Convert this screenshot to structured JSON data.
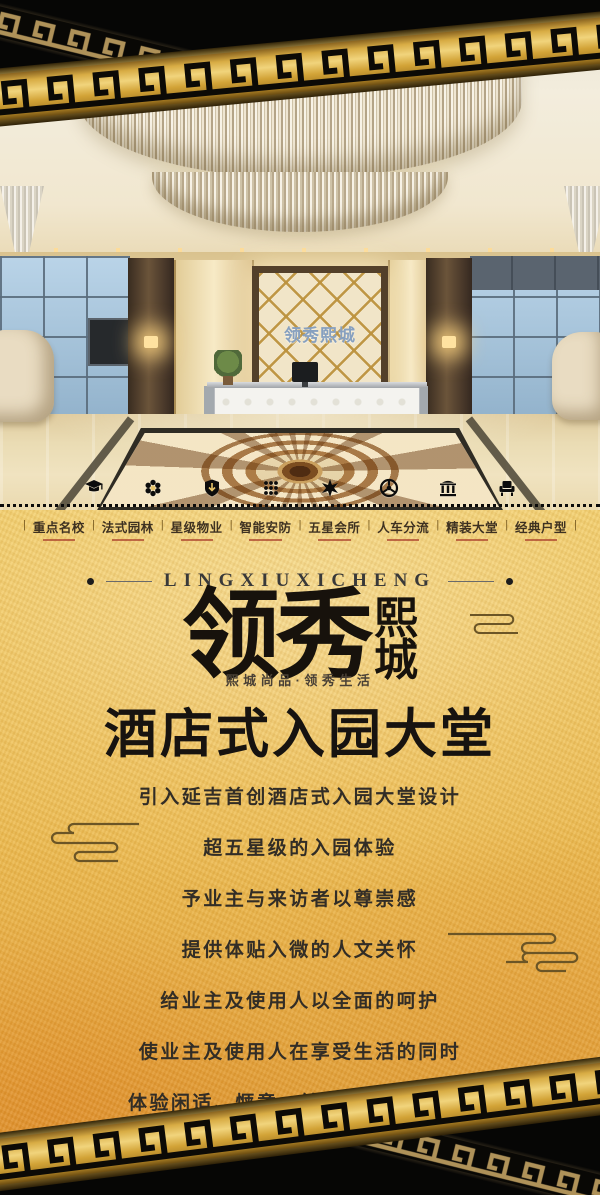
{
  "brand": {
    "latin": "LINGXIUXICHENG",
    "logo_large": "领秀",
    "logo_small_top": "熙",
    "logo_small_bottom": "城",
    "tagline": "熙城尚品·领秀生活"
  },
  "headline": "酒店式入园大堂",
  "body_lines": [
    "引入延吉首创酒店式入园大堂设计",
    "超五星级的入园体验",
    "予业主与来访者以尊崇感",
    "提供体贴入微的人文关怀",
    "给业主及使用人以全面的呵护",
    "使业主及使用人在享受生活的同时",
    "体验闲适、惬意、健康、尊贵的服务"
  ],
  "separator": "|",
  "features": [
    {
      "label": "重点名校",
      "icon": "graduation-cap-icon"
    },
    {
      "label": "法式园林",
      "icon": "flower-icon"
    },
    {
      "label": "星级物业",
      "icon": "shield-icon"
    },
    {
      "label": "智能安防",
      "icon": "keypad-icon"
    },
    {
      "label": "五星会所",
      "icon": "star-flower-icon"
    },
    {
      "label": "人车分流",
      "icon": "steering-wheel-icon"
    },
    {
      "label": "精装大堂",
      "icon": "building-icon"
    },
    {
      "label": "经典户型",
      "icon": "armchair-icon"
    }
  ],
  "photo": {
    "lobby_sign": "领秀熙城"
  },
  "colors": {
    "gold_base": "#ecba4e",
    "gold_deep": "#d8922e",
    "band_gold": "#d8ac44",
    "band_black": "#0a0a0a",
    "text_ink": "#322d26",
    "accent_red": "#a83c2a",
    "locker_blue": "#a5c6dd",
    "lattice_gold": "#bc923d"
  }
}
